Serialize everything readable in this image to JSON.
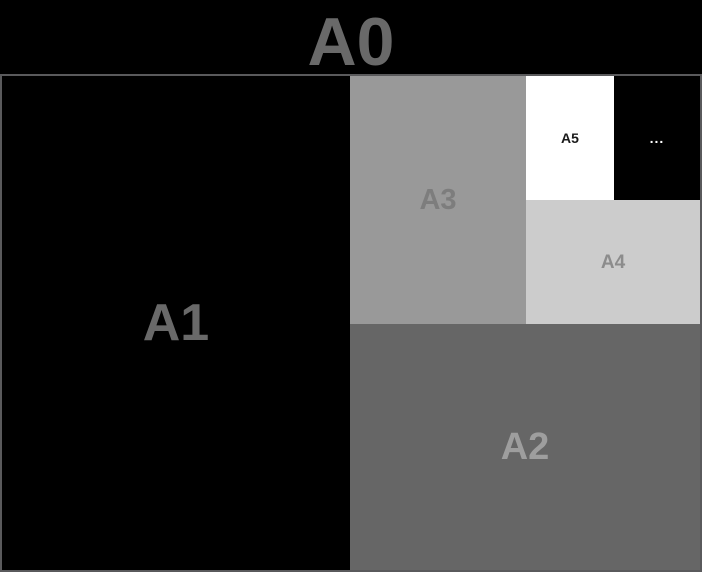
{
  "title": "A0",
  "diagram": {
    "regions": [
      {
        "id": "a1",
        "label": "A1"
      },
      {
        "id": "a2",
        "label": "A2"
      },
      {
        "id": "a3",
        "label": "A3"
      },
      {
        "id": "a4",
        "label": "A4"
      },
      {
        "id": "a5",
        "label": "A5"
      },
      {
        "id": "rest",
        "label": "..."
      }
    ]
  },
  "palette": {
    "page_background": "#000000",
    "sheet_border": "#5a5a5c",
    "title_color": "#696969",
    "a1_fill": "#000000",
    "a1_label_color": "#696969",
    "a2_fill": "#666666",
    "a2_label_color": "#9e9e9e",
    "a3_fill": "#999999",
    "a3_label_color": "#7d7d7d",
    "a4_fill": "#cccccc",
    "a4_label_color": "#8c8c8c",
    "a5_fill": "#ffffff",
    "a5_label_color": "#1a1a1a",
    "rest_fill": "#000000",
    "rest_label_color": "#ffffff"
  }
}
